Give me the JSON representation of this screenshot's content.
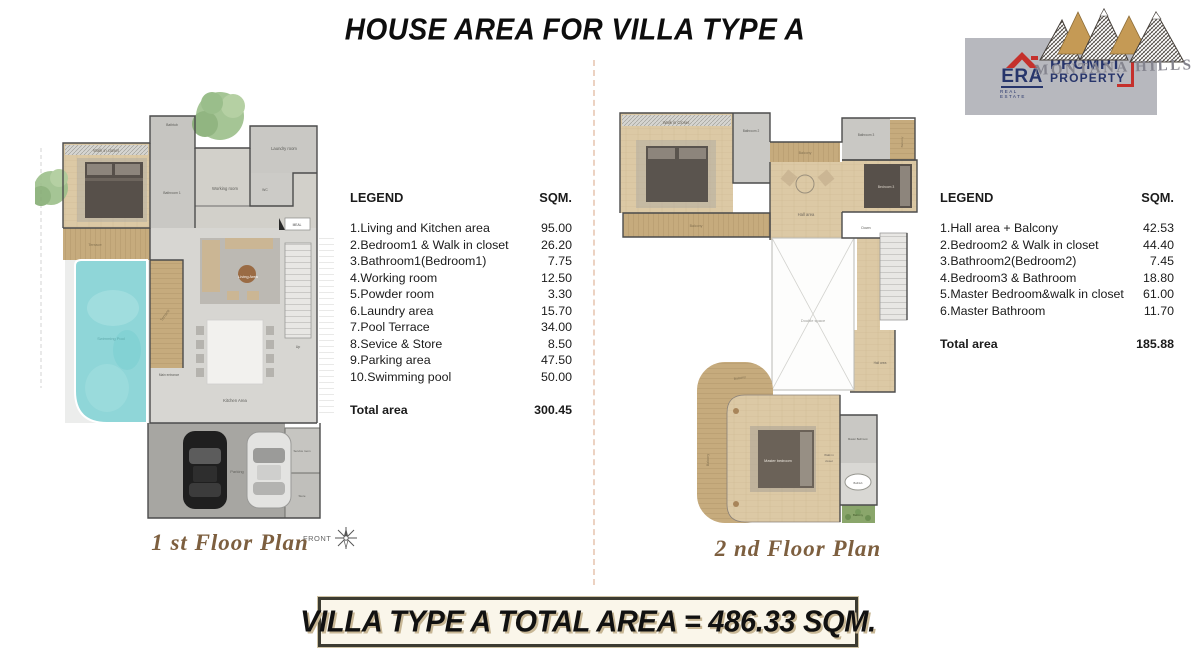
{
  "page": {
    "title": "HOUSE AREA FOR VILLA TYPE A",
    "footer_banner": "VILLA TYPE A TOTAL AREA = 486.33 SQM."
  },
  "branding": {
    "era_name": "ERA",
    "era_sub": "REAL ESTATE",
    "era_line1": "PROMPT",
    "era_line2": "PROPERTY",
    "montana_name": "MONTANA HILLS"
  },
  "colors": {
    "accent_red": "#c5302c",
    "brand_navy": "#27356b",
    "pool": "#8fd6d8",
    "wood_floor": "#dcc9a5",
    "deck": "#c6ab7d",
    "caption_brown": "#7d5f3f",
    "logo_box_gray": "#b7b8be",
    "banner_bg": "#faf6ea"
  },
  "legend1": {
    "header_label": "LEGEND",
    "header_unit": "SQM.",
    "items": [
      {
        "label": "1.Living and Kitchen area",
        "sqm": "95.00"
      },
      {
        "label": "2.Bedroom1 & Walk in closet",
        "sqm": "26.20"
      },
      {
        "label": "3.Bathroom1(Bedroom1)",
        "sqm": "7.75"
      },
      {
        "label": "4.Working room",
        "sqm": "12.50"
      },
      {
        "label": "5.Powder room",
        "sqm": "3.30"
      },
      {
        "label": "6.Laundry area",
        "sqm": "15.70"
      },
      {
        "label": "7.Pool Terrace",
        "sqm": "34.00"
      },
      {
        "label": "8.Sevice & Store",
        "sqm": "8.50"
      },
      {
        "label": "9.Parking area",
        "sqm": "47.50"
      },
      {
        "label": "10.Swimming pool",
        "sqm": "50.00"
      }
    ],
    "total_label": "Total area",
    "total_sqm": "300.45"
  },
  "legend2": {
    "header_label": "LEGEND",
    "header_unit": "SQM.",
    "items": [
      {
        "label": "1.Hall area + Balcony",
        "sqm": "42.53"
      },
      {
        "label": "2.Bedroom2 & Walk in closet",
        "sqm": "44.40"
      },
      {
        "label": "3.Bathroom2(Bedroom2)",
        "sqm": "7.45"
      },
      {
        "label": "4.Bedroom3 & Bathroom",
        "sqm": "18.80"
      },
      {
        "label": "5.Master Bedroom&walk in closet",
        "sqm": "61.00"
      },
      {
        "label": "6.Master Bathroom",
        "sqm": "11.70"
      }
    ],
    "total_label": "Total area",
    "total_sqm": "185.88"
  },
  "plan1": {
    "caption": "1 st Floor Plan",
    "front_label": "FRONT",
    "labels": {
      "walk_in_closet": "Walk in closet",
      "bathtub": "Bathtub",
      "bathroom1": "Bathroom 1",
      "working_room": "Working room",
      "laundry_room": "Laundry room",
      "wc": "WC",
      "terrace_top": "Terrace",
      "terrace_side": "Terrace",
      "swimming_pool": "Swimming Pool",
      "living_area": "Living Area",
      "main_entrance": "Main entrance",
      "kitchen_area": "Kitchen Area",
      "up": "Up",
      "meal": "MEAL",
      "parking": "Parking",
      "service_room": "Service room",
      "store": "Store"
    }
  },
  "plan2": {
    "caption": "2 nd Floor Plan",
    "labels": {
      "walk_in_closet": "Walk in Closet",
      "bathroom2": "Bathroom 2",
      "balcony_top": "Balcony",
      "bathroom3": "Bathroom 3",
      "balcony_right": "Balcony",
      "bedroom3": "Bedroom 3",
      "hall_area": "Hall area",
      "balcony_mid": "Balcony",
      "down": "Down",
      "double_space": "Double space",
      "hall_area2": "Hall area",
      "balcony_curve_top": "Balcony",
      "balcony_curve_left": "Balcony",
      "master_bedroom": "Master bedroom",
      "walk_in_1": "Walk in",
      "walk_in_2": "closet",
      "master_bathroom": "Master Bathroom",
      "bathtub": "Bathtub",
      "balcony_small": "Balcony"
    }
  }
}
